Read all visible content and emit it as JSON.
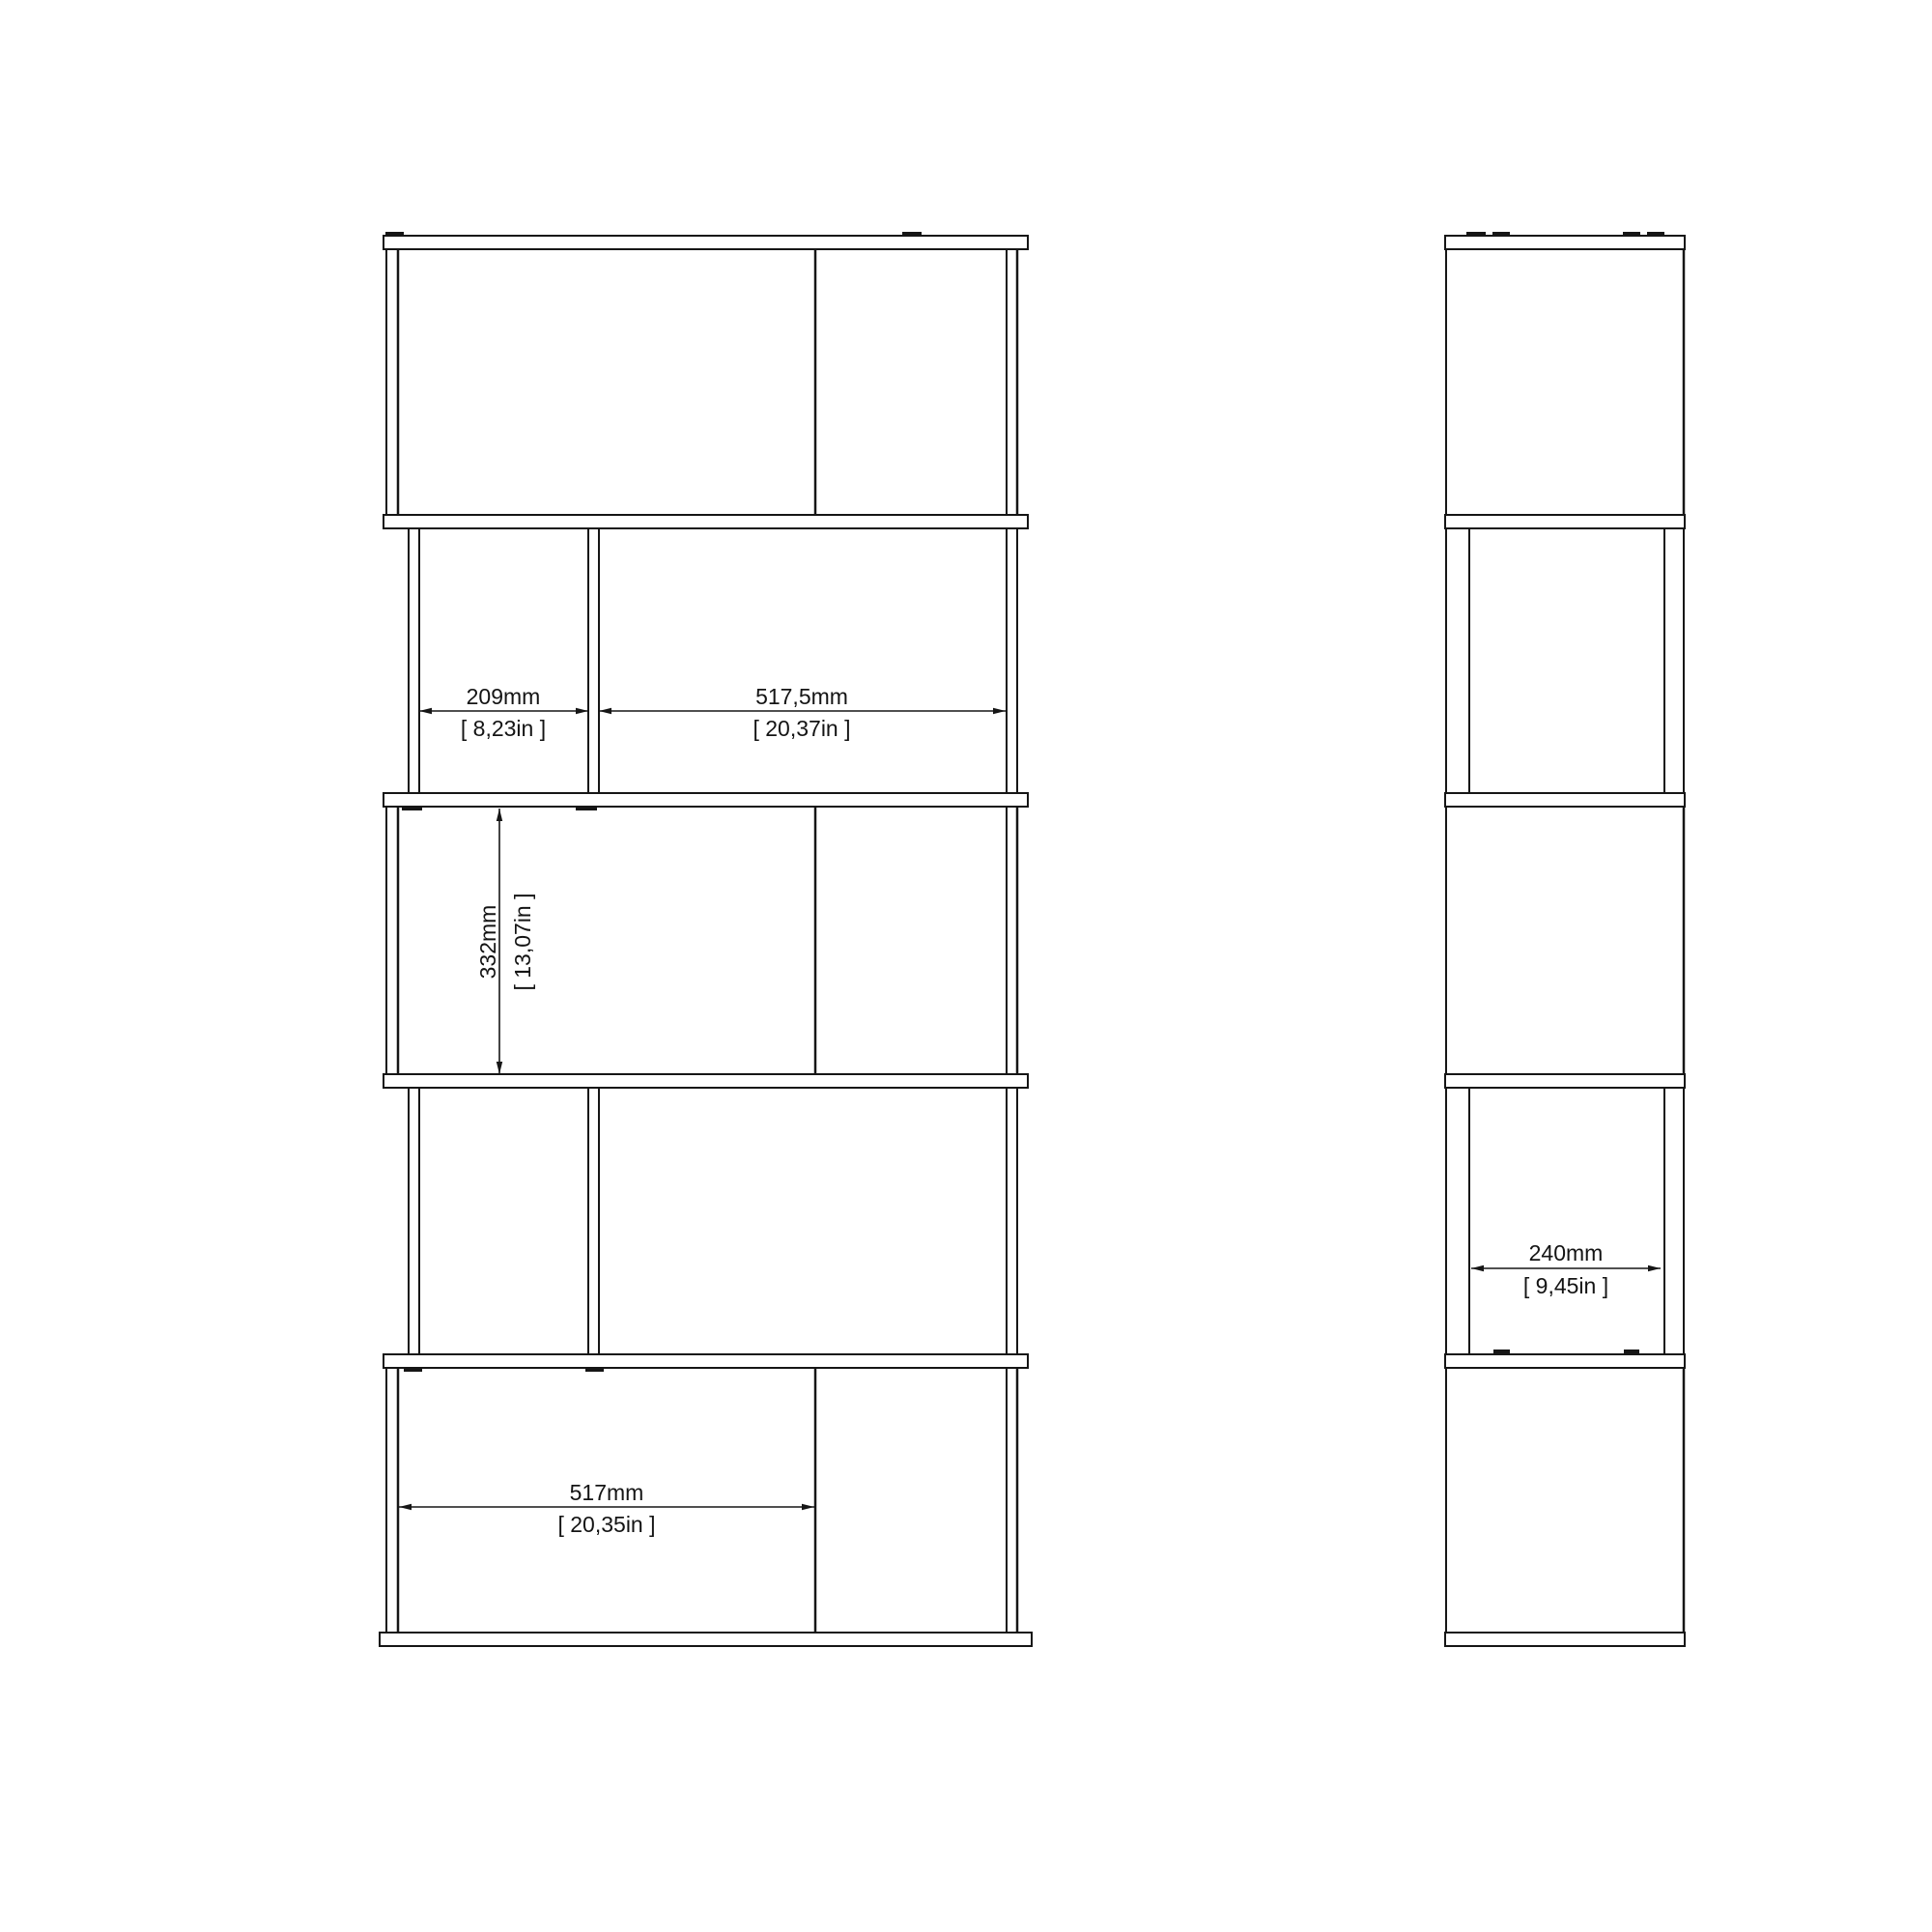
{
  "drawing": {
    "type": "furniture-technical-drawing",
    "colors": {
      "background": "#ffffff",
      "line": "#161616",
      "text": "#141414"
    },
    "dims": {
      "d209": {
        "mm": "209mm",
        "in": "[ 8,23in ]"
      },
      "d5175": {
        "mm": "517,5mm",
        "in": "[ 20,37in ]"
      },
      "d332": {
        "mm": "332mm",
        "in": "[ 13,07in ]"
      },
      "d517": {
        "mm": "517mm",
        "in": "[ 20,35in ]"
      },
      "d240": {
        "mm": "240mm",
        "in": "[ 9,45in ]"
      }
    }
  }
}
